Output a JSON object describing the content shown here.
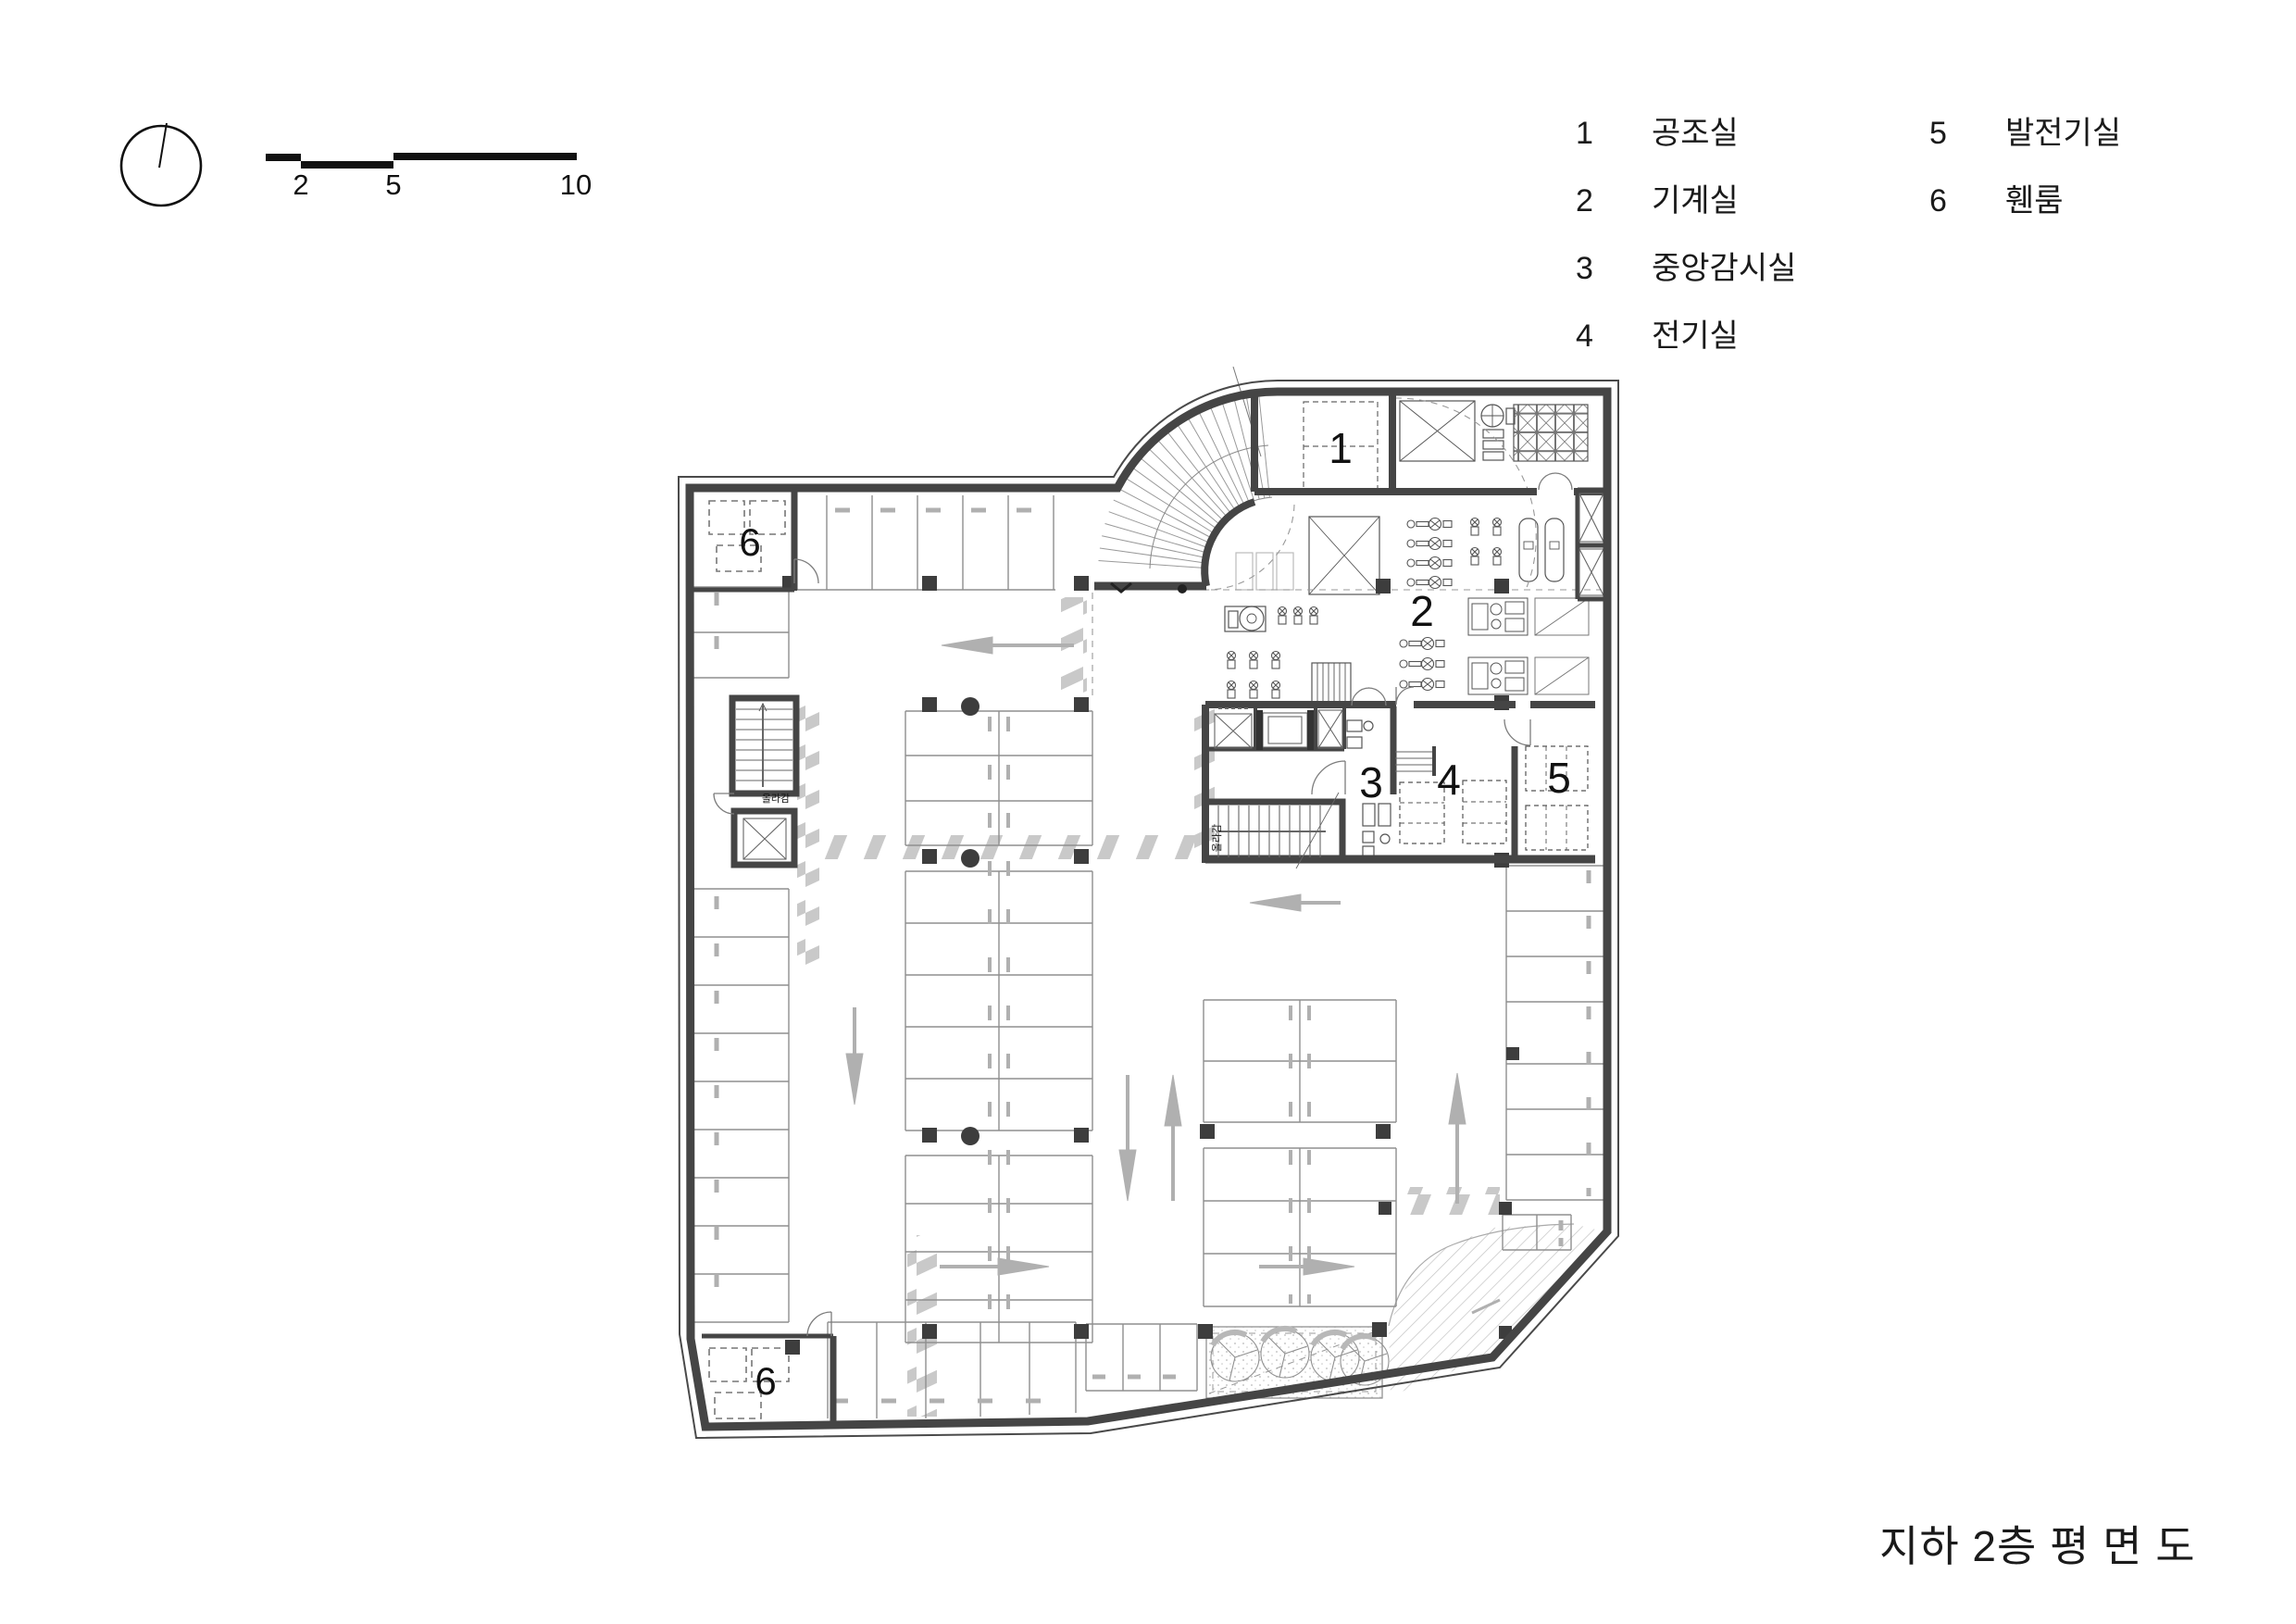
{
  "sheet": {
    "title": "지하 2층 평 면 도"
  },
  "scale_bar": {
    "ticks": [
      "2",
      "5",
      "10"
    ]
  },
  "legend": {
    "entries": [
      {
        "num": "1",
        "label": "공조실"
      },
      {
        "num": "2",
        "label": "기계실"
      },
      {
        "num": "3",
        "label": "중앙감시실"
      },
      {
        "num": "4",
        "label": "전기실"
      },
      {
        "num": "5",
        "label": "발전기실"
      },
      {
        "num": "6",
        "label": "휀룸"
      }
    ]
  },
  "plan": {
    "room_labels": [
      {
        "text": "1",
        "room": "공조실"
      },
      {
        "text": "2",
        "room": "기계실"
      },
      {
        "text": "3",
        "room": "중앙감시실"
      },
      {
        "text": "4",
        "room": "전기실"
      },
      {
        "text": "5",
        "room": "발전기실"
      },
      {
        "text": "6",
        "room": "휀룸"
      },
      {
        "text": "6",
        "room": "휀룸"
      }
    ],
    "stair_note": "올라감",
    "colors": {
      "wall": "#454545",
      "line": "#8f8f8f",
      "zebra": "#c9c9c9",
      "arrow": "#b0b0b0"
    }
  }
}
